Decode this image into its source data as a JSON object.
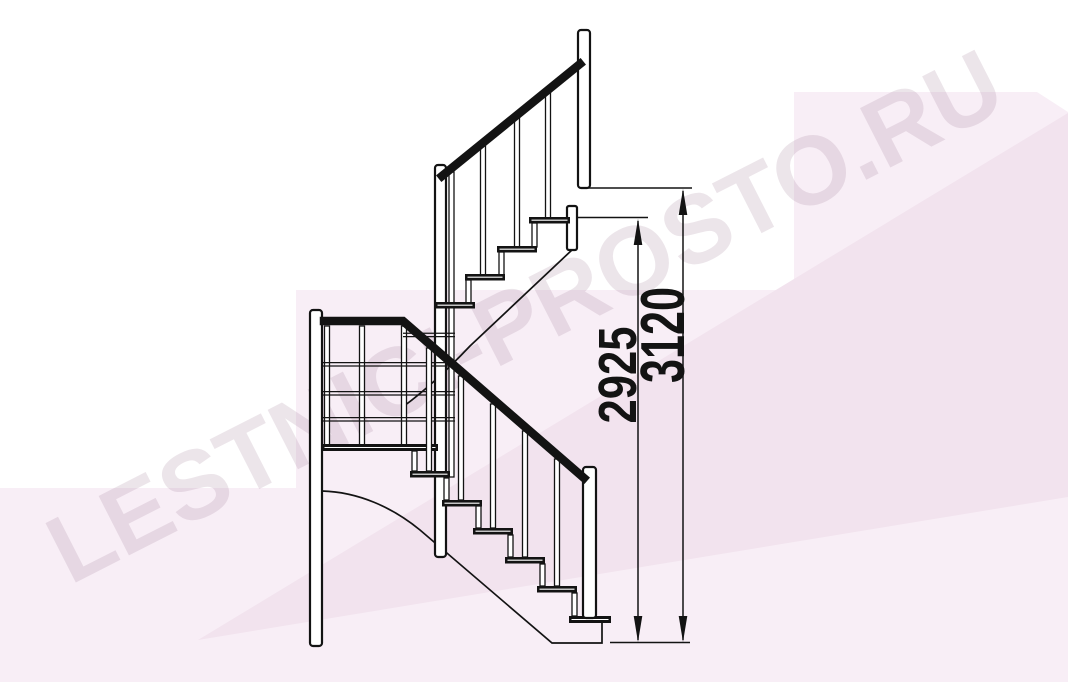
{
  "page": {
    "background": "#ffffff"
  },
  "watermark": {
    "text": "LESTNICI-PROSTO.RU"
  },
  "drawing": {
    "type": "staircase-side-elevation",
    "dimensions": [
      {
        "name": "height-to-landing-tread",
        "label": "2925"
      },
      {
        "name": "overall-height",
        "label": "3120"
      }
    ]
  },
  "colors": {
    "line_color": "#131313",
    "pink_main": "#f8eef6",
    "pink_dark": "#f2e3ee",
    "watermark_text_color": "rgba(167,138,161,0.22)"
  }
}
